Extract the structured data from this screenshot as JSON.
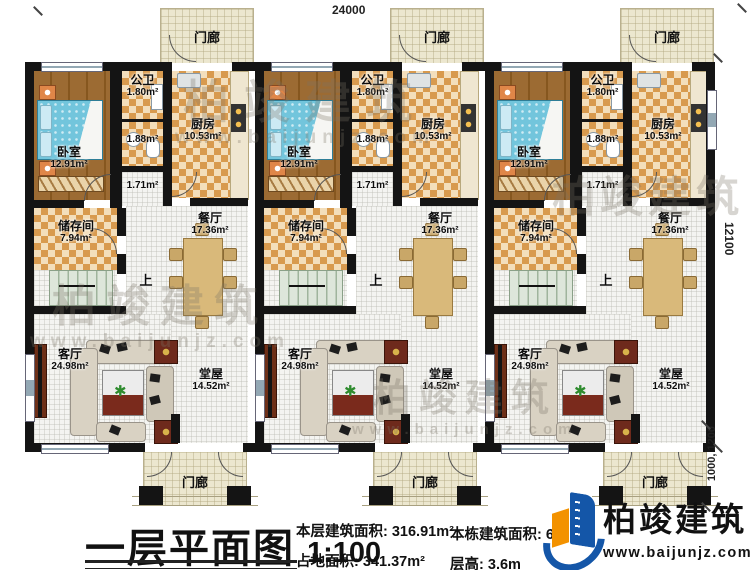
{
  "dimensions": {
    "width_top": "24000",
    "height_right": "12100",
    "porch_depth": "1000, 1200"
  },
  "rooms": {
    "porch": {
      "name": "门廊"
    },
    "bedroom": {
      "name": "卧室",
      "area": "12.91m²"
    },
    "public_bath": {
      "name": "公卫",
      "area": "1.80m²"
    },
    "bath": {
      "area": "1.88m²"
    },
    "hallway": {
      "area": "1.71m²"
    },
    "kitchen": {
      "name": "厨房",
      "area": "10.53m²"
    },
    "storage": {
      "name": "储存间",
      "area": "7.94m²"
    },
    "dining": {
      "name": "餐厅",
      "area": "17.36m²"
    },
    "living": {
      "name": "客厅",
      "area": "24.98m²"
    },
    "main_hall": {
      "name": "堂屋",
      "area": "14.52m²"
    },
    "stairs": {
      "up_label": "上"
    }
  },
  "footer": {
    "plan_title": "一层平面图",
    "plan_scale": "1:100",
    "stats": [
      {
        "label": "本层建筑面积:",
        "value": "316.91m²"
      },
      {
        "label": "占地面积:",
        "value": "341.37m²"
      },
      {
        "label": "本栋建筑面积:",
        "value": "6"
      },
      {
        "label": "层高:",
        "value": "3.6m"
      }
    ]
  },
  "brand": {
    "name": "柏竣建筑",
    "website": "www.baijunjz.com"
  },
  "watermark": {
    "text": "柏竣建筑",
    "website": "www.baijunjz.com"
  },
  "colors": {
    "wall": "#141414",
    "checker_dark": "#d89a4e",
    "checker_light": "#f3debb",
    "bed": "#72c5dc",
    "logo_blue": "#1456a8",
    "logo_orange": "#f39200"
  }
}
